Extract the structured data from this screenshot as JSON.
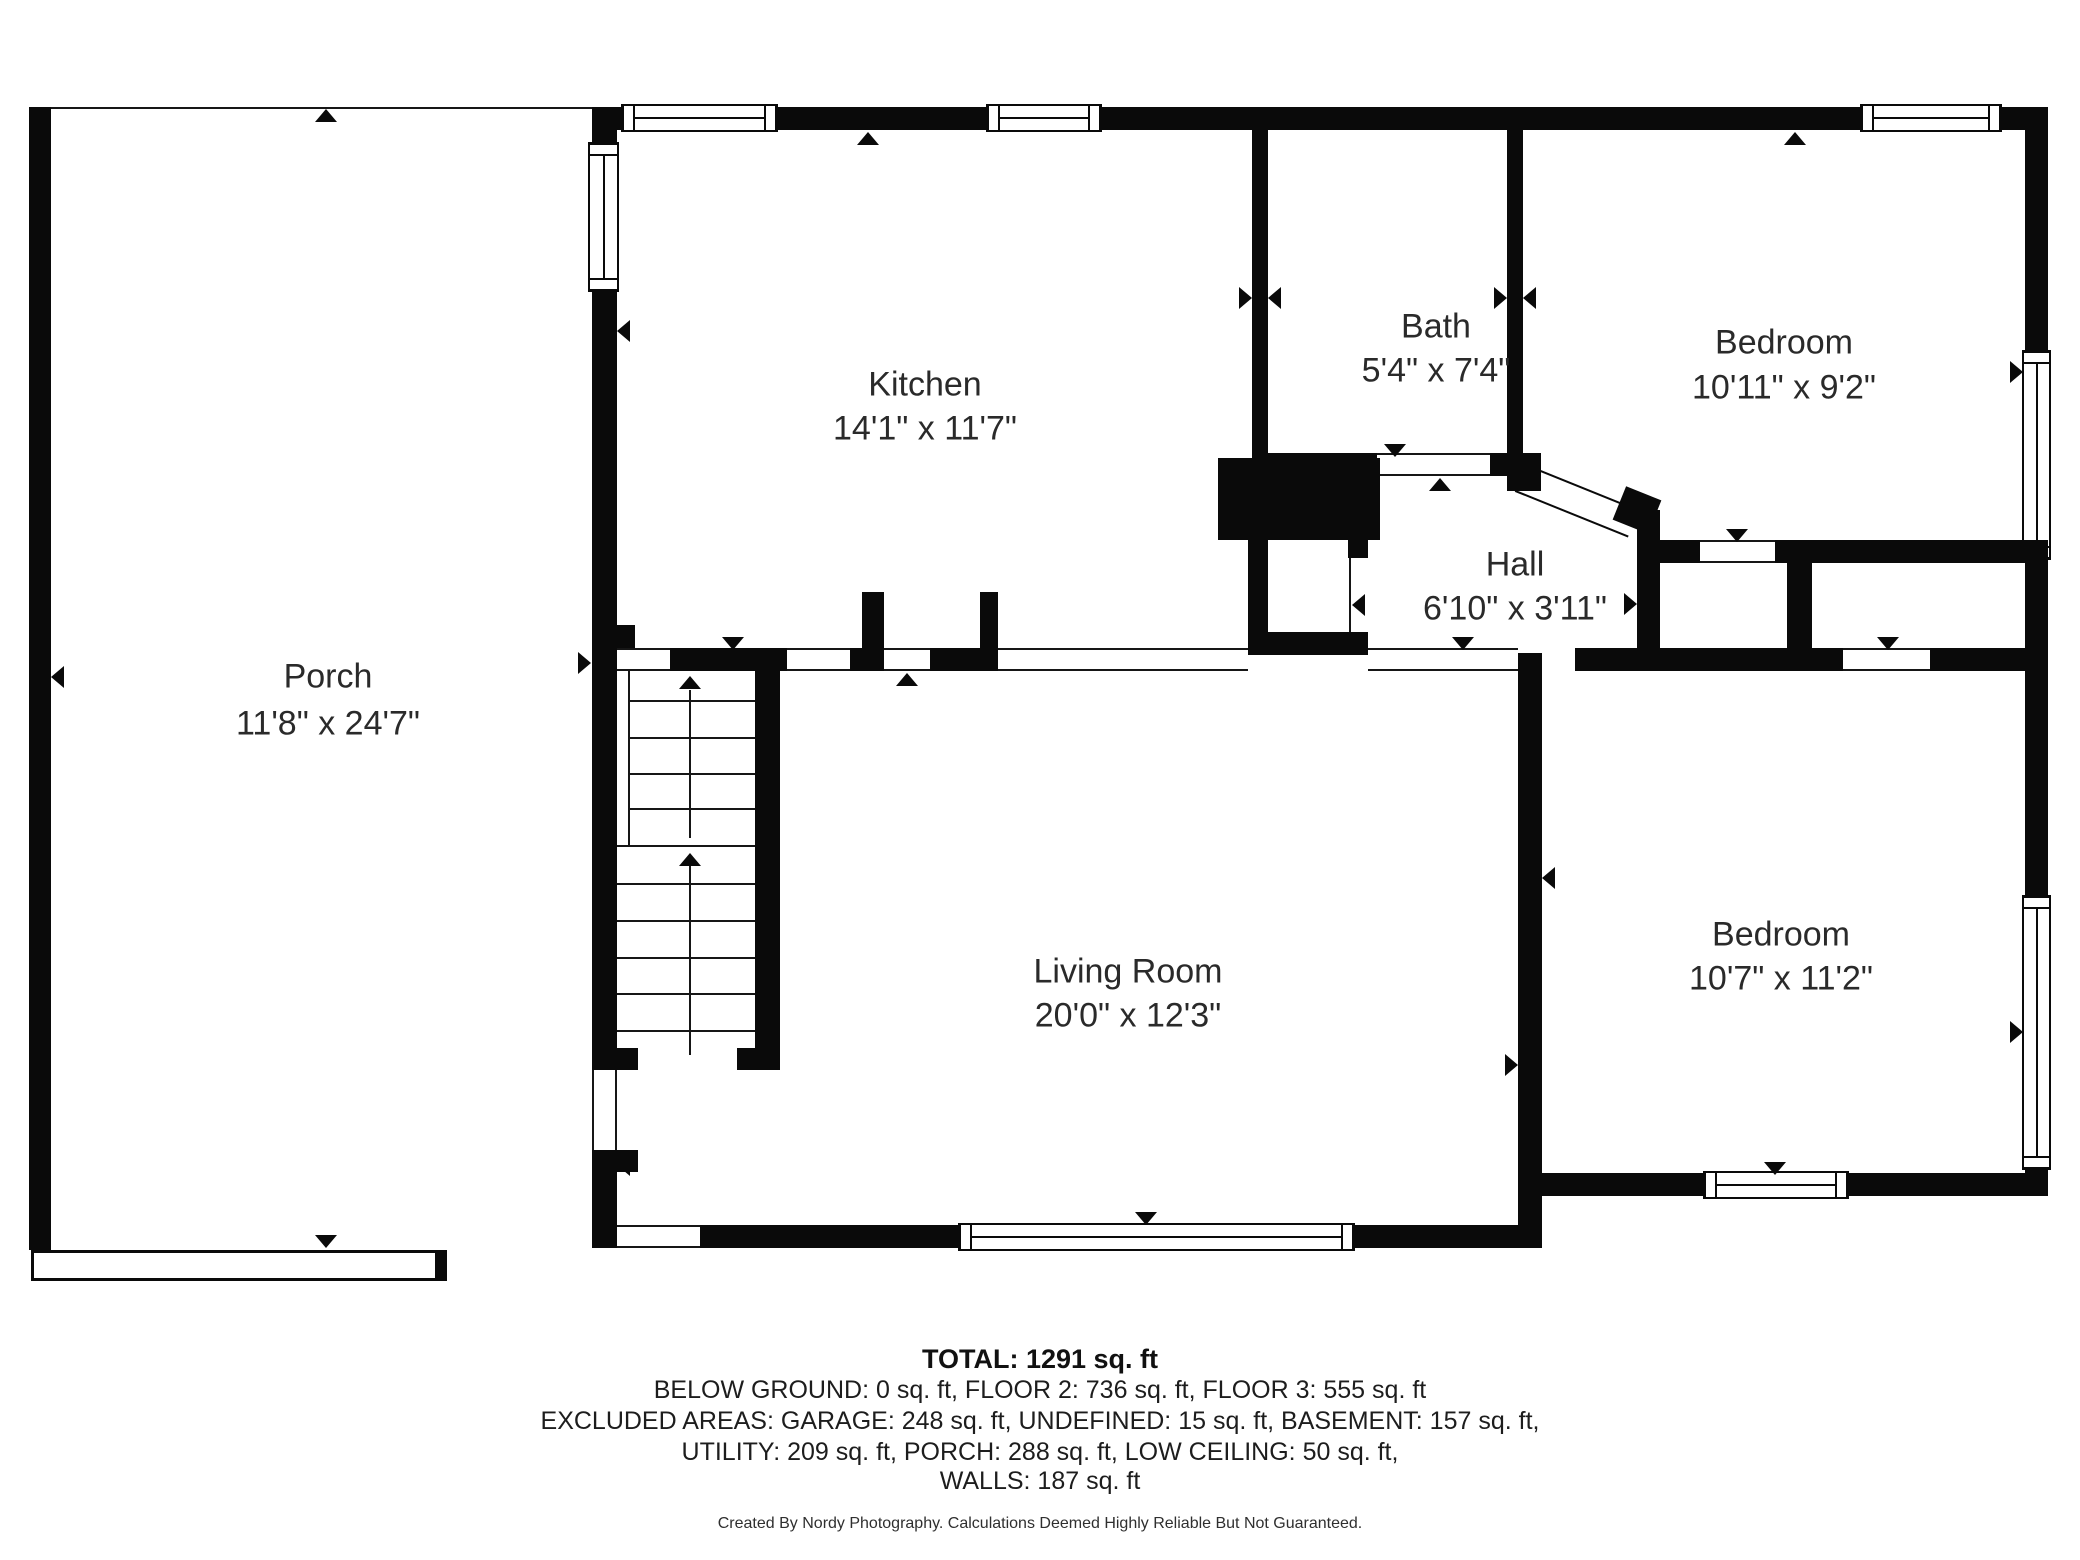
{
  "meta": {
    "type": "floor-plan",
    "background_color": "#ffffff",
    "wall_color": "#0a0a0a",
    "text_color": "#2a2a2a"
  },
  "rooms": [
    {
      "id": "porch",
      "name": "Porch",
      "dims": "11'8\" x 24'7\""
    },
    {
      "id": "kitchen",
      "name": "Kitchen",
      "dims": "14'1\" x 11'7\""
    },
    {
      "id": "bath",
      "name": "Bath",
      "dims": "5'4\" x 7'4\""
    },
    {
      "id": "bedroom-top",
      "name": "Bedroom",
      "dims": "10'11\" x 9'2\""
    },
    {
      "id": "hall",
      "name": "Hall",
      "dims": "6'10\" x 3'11\""
    },
    {
      "id": "living-room",
      "name": "Living Room",
      "dims": "20'0\" x 12'3\""
    },
    {
      "id": "bedroom-bottom",
      "name": "Bedroom",
      "dims": "10'7\" x 11'2\""
    }
  ],
  "summary": {
    "total": "TOTAL: 1291 sq. ft",
    "line2": "BELOW GROUND: 0 sq. ft, FLOOR 2: 736 sq. ft, FLOOR 3: 555 sq. ft",
    "line3": "EXCLUDED AREAS: GARAGE: 248 sq. ft, UNDEFINED: 15 sq. ft, BASEMENT: 157 sq. ft,",
    "line4": "UTILITY: 209 sq. ft, PORCH: 288 sq. ft, LOW CEILING: 50 sq. ft,",
    "line5": "WALLS: 187 sq. ft"
  },
  "footer": "Created By Nordy Photography. Calculations Deemed Highly Reliable But Not Guaranteed."
}
